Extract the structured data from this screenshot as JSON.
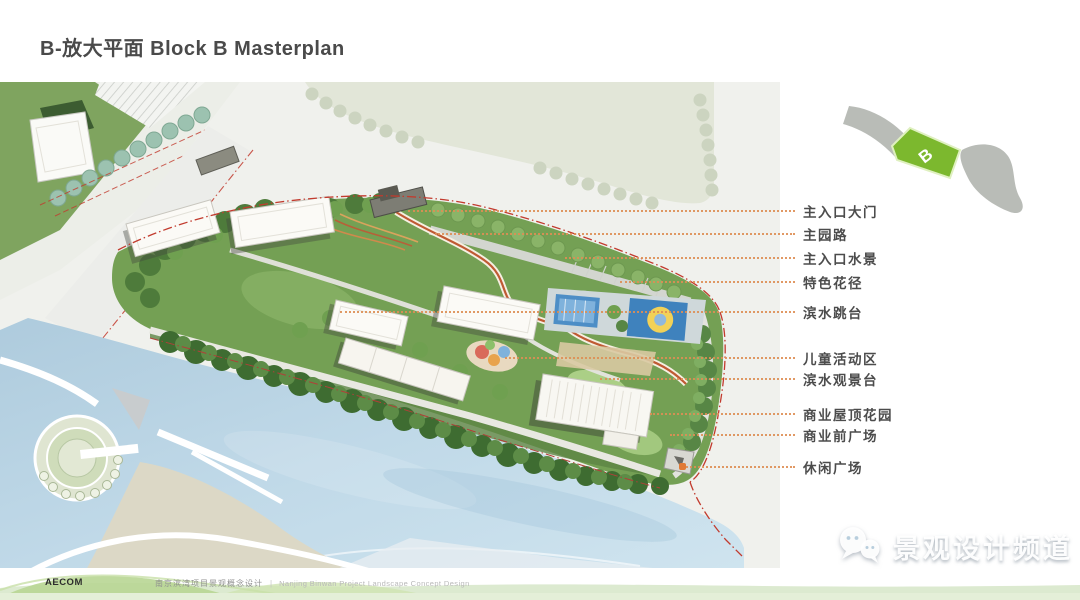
{
  "slide": {
    "title": "B-放大平面 Block B Masterplan",
    "watermark": {
      "text": "景观设计频道",
      "icon": "wechat-chat-bubbles"
    },
    "footer": {
      "logo": "AECOM",
      "project_cn": "南京滨湾项目景观概念设计",
      "divider": "|",
      "project_en": "Nanjing Binwan Project Landscape Concept Design"
    },
    "locator": {
      "block_label": "B"
    }
  },
  "callouts": [
    {
      "label": "主入口大门",
      "y": 210,
      "x_start": 408
    },
    {
      "label": "主园路",
      "y": 233,
      "x_start": 435
    },
    {
      "label": "主入口水景",
      "y": 257,
      "x_start": 565
    },
    {
      "label": "特色花径",
      "y": 281,
      "x_start": 620
    },
    {
      "label": "滨水跳台",
      "y": 311,
      "x_start": 340
    },
    {
      "label": "儿童活动区",
      "y": 357,
      "x_start": 505
    },
    {
      "label": "滨水观景台",
      "y": 378,
      "x_start": 600
    },
    {
      "label": "商业屋顶花园",
      "y": 413,
      "x_start": 650
    },
    {
      "label": "商业前广场",
      "y": 434,
      "x_start": 670
    },
    {
      "label": "休闲广场",
      "y": 466,
      "x_start": 683,
      "dot": true
    }
  ],
  "colors": {
    "accent_green": "#7cb82e",
    "leader_orange": "#de8f55",
    "boundary_red": "#c23b2e",
    "water_blue": "#bdd6e5",
    "title_gray": "#4a4a4a"
  }
}
